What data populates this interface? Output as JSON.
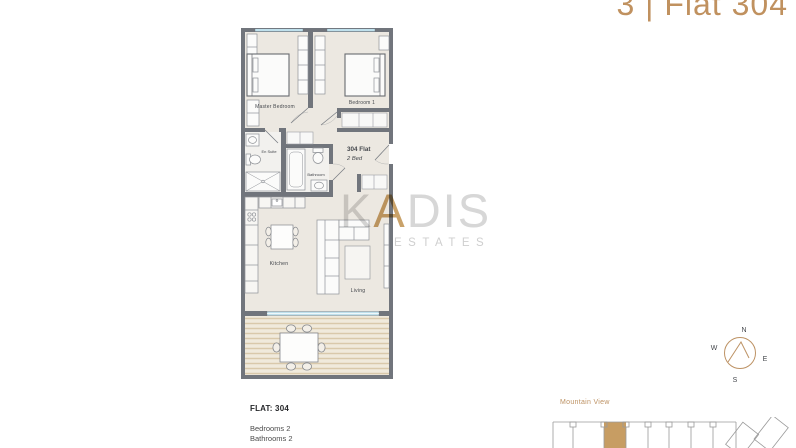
{
  "header": {
    "title": "3 | Flat 304"
  },
  "watermark": {
    "part1": "K",
    "accent": "A",
    "part2": "DIS",
    "subtitle": "ESTATES"
  },
  "floor_plan": {
    "flat_label": "304 Flat",
    "flat_type": "2 Bed",
    "rooms": {
      "master_bedroom": "Master Bedroom",
      "bedroom_1": "Bedroom 1",
      "en_suite": "En Suite",
      "bathroom": "Bathroom",
      "kitchen": "Kitchen",
      "living": "Living"
    }
  },
  "compass": {
    "n": "N",
    "w": "W",
    "e": "E",
    "s": "S"
  },
  "details": {
    "flat_heading": "FLAT: 304",
    "lines": [
      {
        "label": "Bedrooms",
        "value": "2"
      },
      {
        "label": "Bathrooms",
        "value": "2"
      }
    ]
  },
  "locator": {
    "view_label": "Mountain View"
  },
  "colors": {
    "accent": "#bd9264",
    "wall": "#71757c",
    "floor": "#ece8e1",
    "window": "#bfe0ec",
    "deck": "#ebe2d1",
    "highlight_unit": "#c79d63",
    "watermark_gray": "#d7d7d7"
  }
}
